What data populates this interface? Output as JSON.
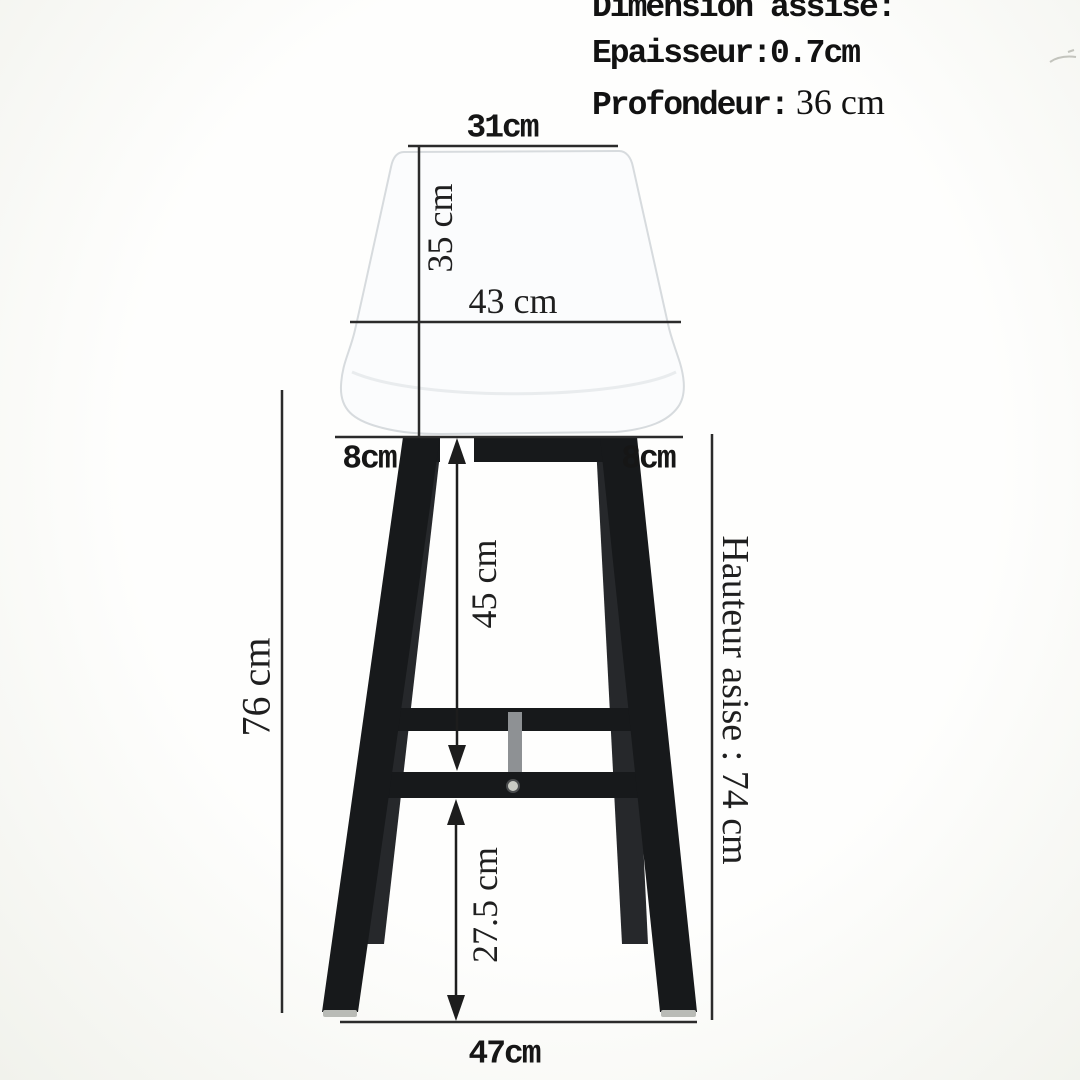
{
  "header": {
    "title": "Dimension assise:",
    "thickness": "Epaisseur:0.7cm",
    "depth_label": "Profondeur:",
    "depth_value": "36 cm"
  },
  "dimensions": {
    "backrest_top_width": "31cm",
    "backrest_height": "35 cm",
    "seat_width": "43 cm",
    "seat_overhang_left": "8cm",
    "seat_overhang_right": "8cm",
    "seat_to_footrest": "45 cm",
    "footrest_to_floor": "27.5 cm",
    "overall_height": "76 cm",
    "seat_height": "Hauteur asise : 74 cm",
    "base_width": "47cm"
  },
  "colors": {
    "background": "#f2f3ee",
    "seat": "#fbfcfd",
    "seat_edge": "#d7dbde",
    "metal": "#17191b",
    "metal_rear": "#26282b",
    "strut": "#8e9194",
    "dim_line": "#2b2b2b",
    "screw": "#c9cbc4"
  }
}
